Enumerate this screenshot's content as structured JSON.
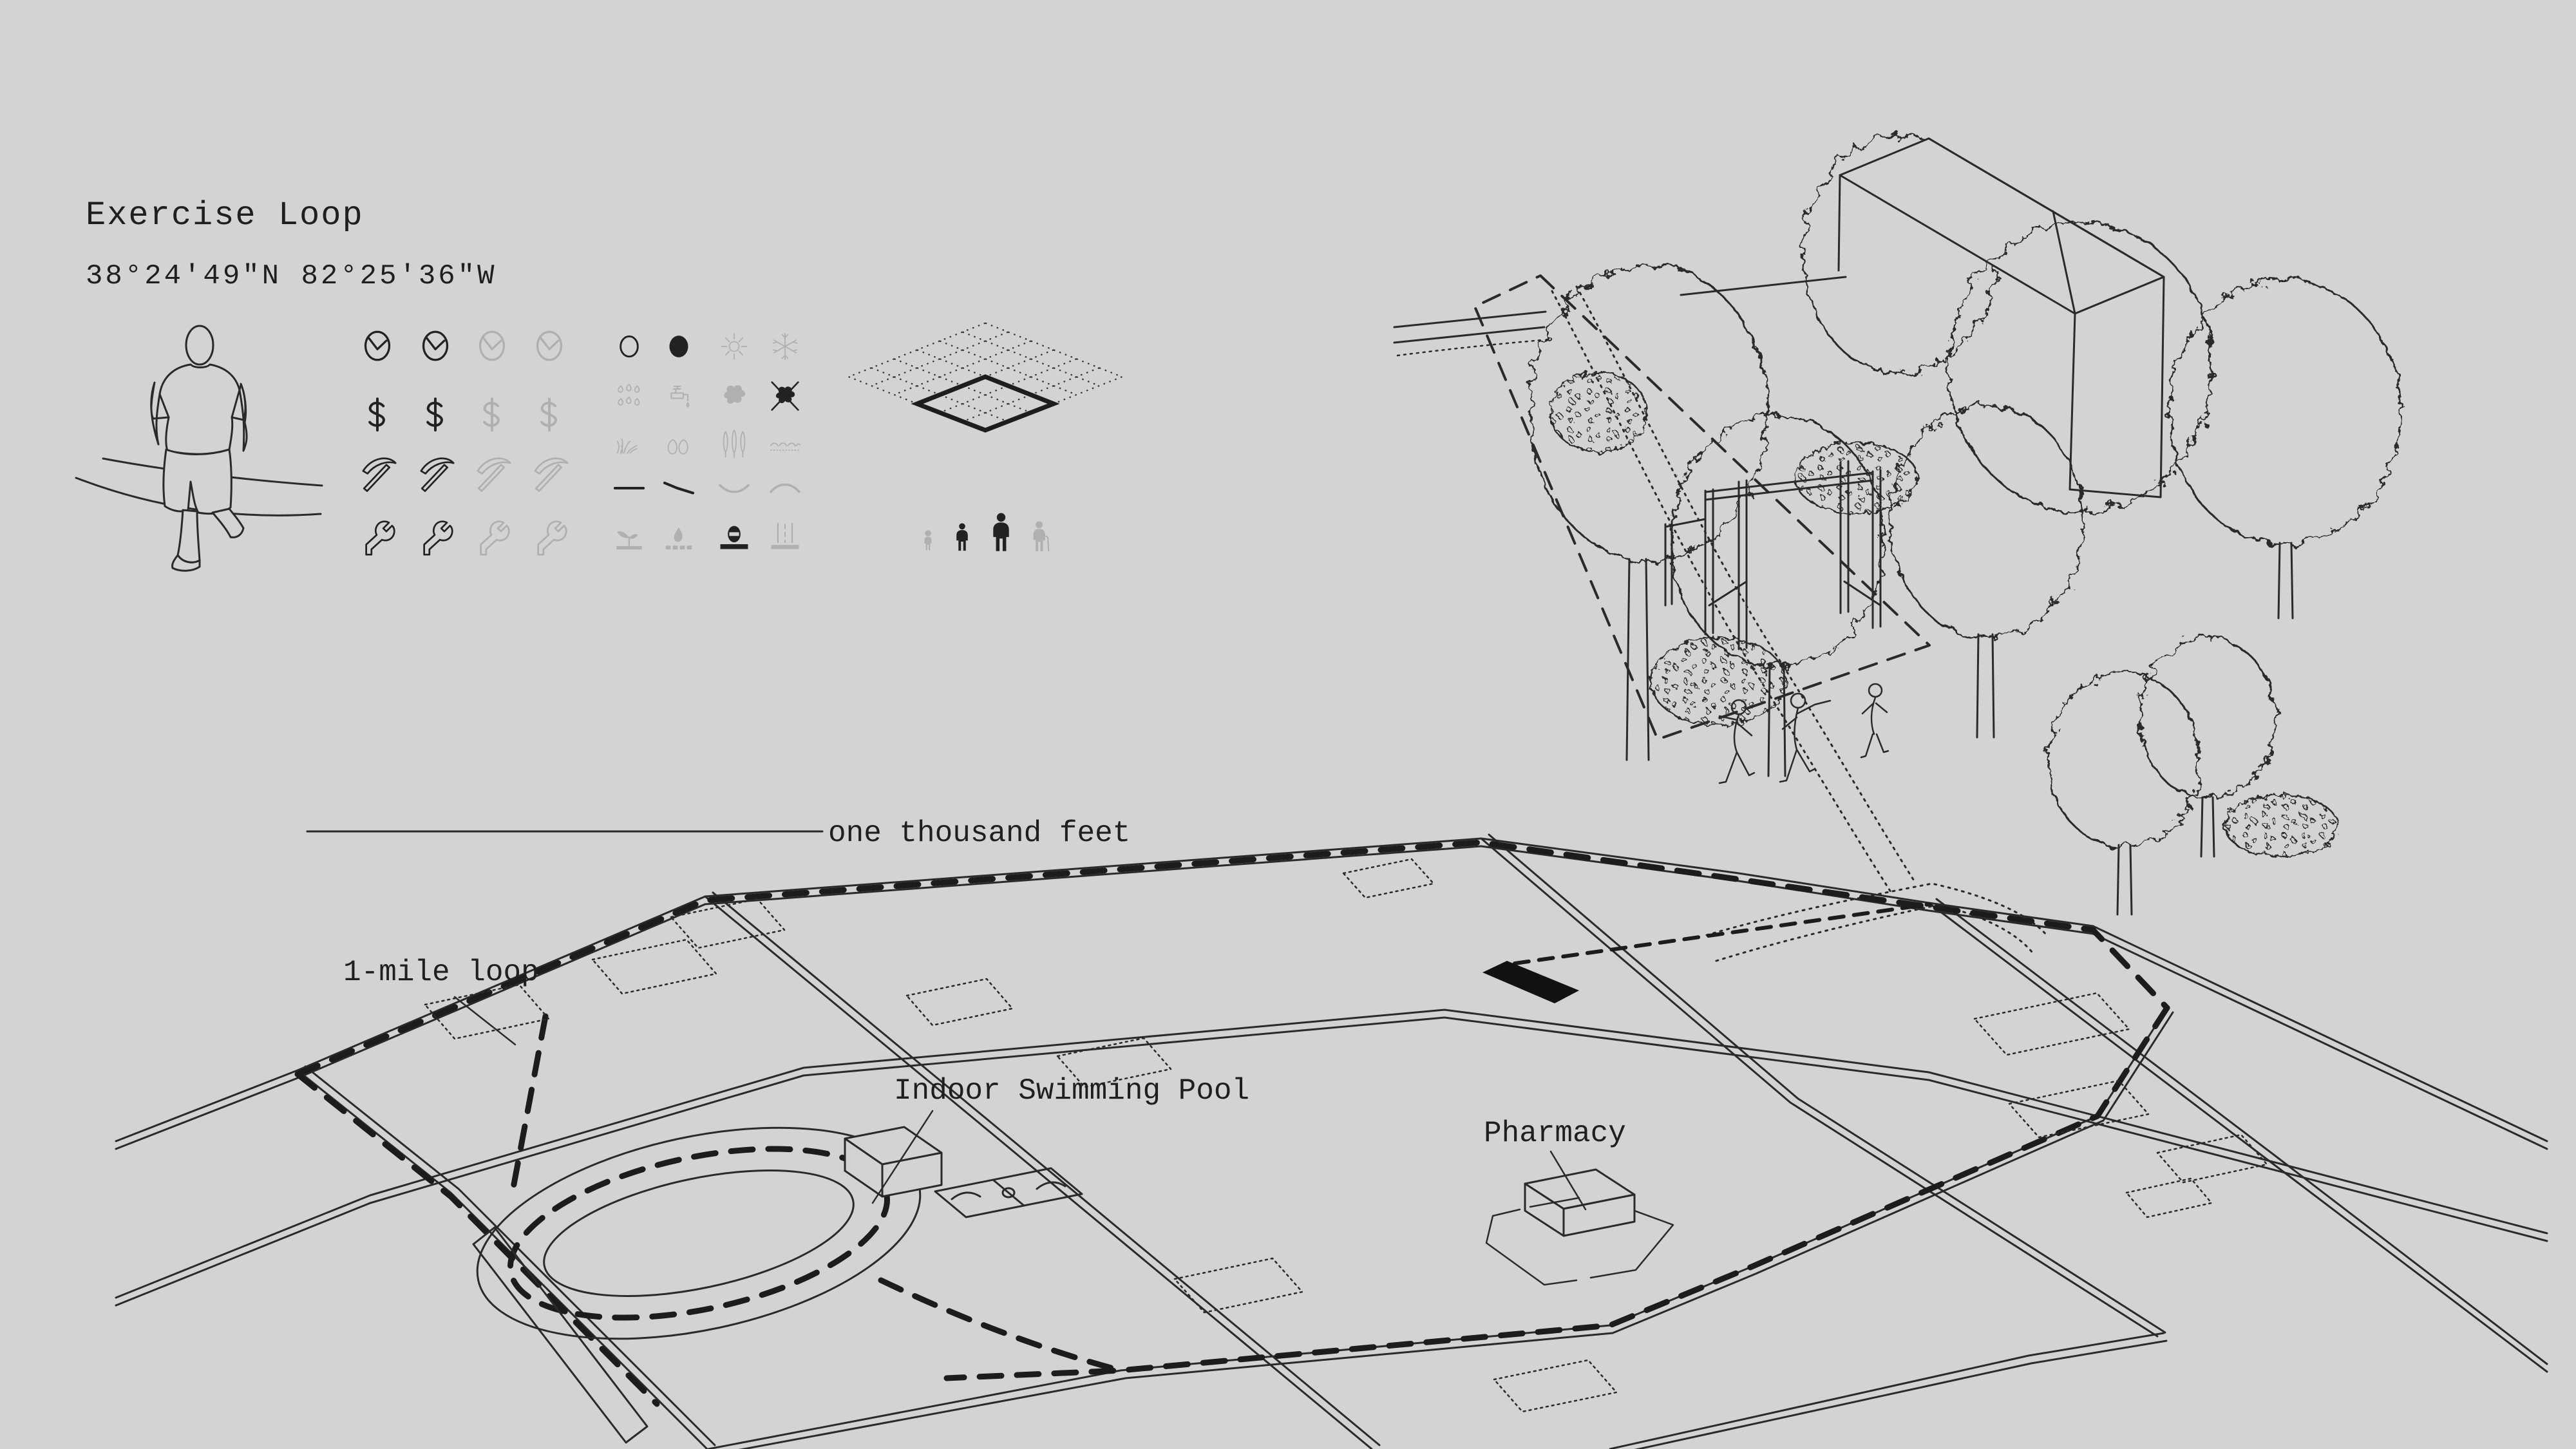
{
  "page": {
    "background_color": "#d3d3d3",
    "line_color": "#2a2a2a",
    "active_icon_color": "#222222",
    "inactive_icon_color": "#b0b0b0"
  },
  "header": {
    "title": "Exercise Loop",
    "coordinates": "38°24'49\"N  82°25'36\"W"
  },
  "scale_bar": {
    "label": "one thousand feet"
  },
  "map": {
    "labels": {
      "loop": "1-mile loop",
      "pool": "Indoor Swimming Pool",
      "pharmacy": "Pharmacy"
    },
    "features": [
      "running-track-oval",
      "basketball-court",
      "pool-building",
      "pharmacy-building",
      "highlighted-site-parallelogram",
      "dashed-1-mile-loop-route",
      "dotted-building-footprints",
      "street-grid"
    ]
  },
  "legend": {
    "rating_rows": [
      {
        "icon": "clock",
        "states": [
          "dark",
          "dark",
          "gray",
          "gray"
        ]
      },
      {
        "icon": "dollar",
        "states": [
          "dark",
          "dark",
          "gray",
          "gray"
        ]
      },
      {
        "icon": "pickaxe",
        "states": [
          "dark",
          "dark",
          "gray",
          "gray"
        ]
      },
      {
        "icon": "wrench",
        "states": [
          "dark",
          "dark",
          "gray",
          "gray"
        ]
      }
    ],
    "attribute_rows": [
      {
        "icons": [
          "circle-outline",
          "circle-filled",
          "sun",
          "snowflake"
        ],
        "states": [
          "dark",
          "dark",
          "gray",
          "gray"
        ]
      },
      {
        "icons": [
          "rain",
          "faucet",
          "splat",
          "splat-crossed"
        ],
        "states": [
          "gray",
          "gray",
          "gray",
          "dark"
        ]
      },
      {
        "icons": [
          "grass",
          "stones",
          "poplars",
          "ripples"
        ],
        "states": [
          "gray",
          "gray",
          "gray",
          "gray"
        ]
      },
      {
        "icons": [
          "flat-line",
          "slope-line",
          "valley-line",
          "hill-line"
        ],
        "states": [
          "dark",
          "dark",
          "gray",
          "gray"
        ]
      },
      {
        "icons": [
          "sprout",
          "droplet-base",
          "no-entry-base",
          "road-markings"
        ],
        "states": [
          "gray",
          "gray",
          "dark",
          "gray"
        ]
      }
    ],
    "site_grid": {
      "rows": 6,
      "cols": 6,
      "highlighted_cells": "3x3 lower quadrant"
    },
    "people": [
      {
        "name": "toddler",
        "tone": "gray"
      },
      {
        "name": "child",
        "tone": "dark"
      },
      {
        "name": "adult",
        "tone": "dark"
      },
      {
        "name": "elderly-with-cane",
        "tone": "gray"
      }
    ]
  },
  "axon_scene": {
    "elements": [
      "scribbly-trees",
      "gable-house",
      "stippled-bushes",
      "dashed-parcel-boundary",
      "pull-up-bar-frame",
      "two-stretching-figures",
      "small-jogger-on-path",
      "dotted-footpath"
    ]
  },
  "hero_figure": "jogger-line-drawing"
}
